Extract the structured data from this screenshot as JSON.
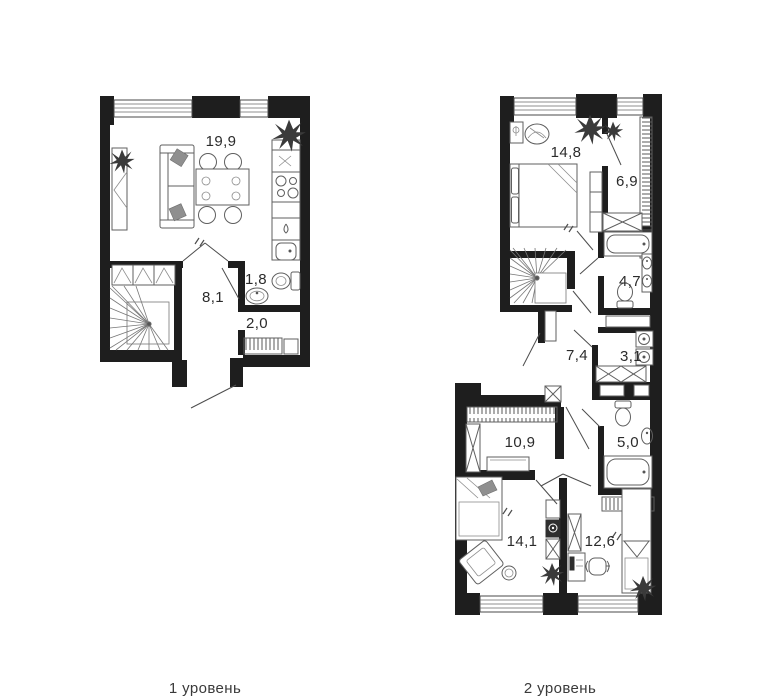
{
  "plan": {
    "type": "duplex-floor-plan",
    "colors": {
      "wall": "#1e1e1e",
      "furniture": "#5f5f5f",
      "label": "#2b2b2b",
      "background": "#ffffff"
    },
    "levels": [
      {
        "caption": "1 уровень",
        "rooms": [
          {
            "name": "living-kitchen",
            "area": "19,9"
          },
          {
            "name": "wc",
            "area": "1,8"
          },
          {
            "name": "hallway",
            "area": "8,1"
          },
          {
            "name": "closet",
            "area": "2,0"
          }
        ]
      },
      {
        "caption": "2 уровень",
        "rooms": [
          {
            "name": "bedroom",
            "area": "14,8"
          },
          {
            "name": "wardrobe-room",
            "area": "6,9"
          },
          {
            "name": "bathroom",
            "area": "4,7"
          },
          {
            "name": "corridor",
            "area": "7,4"
          },
          {
            "name": "laundry",
            "area": "3,1"
          },
          {
            "name": "dressing-room",
            "area": "10,9"
          },
          {
            "name": "bathroom-2",
            "area": "5,0"
          },
          {
            "name": "bedroom-2",
            "area": "14,1"
          },
          {
            "name": "bedroom-3",
            "area": "12,6"
          }
        ]
      }
    ]
  }
}
